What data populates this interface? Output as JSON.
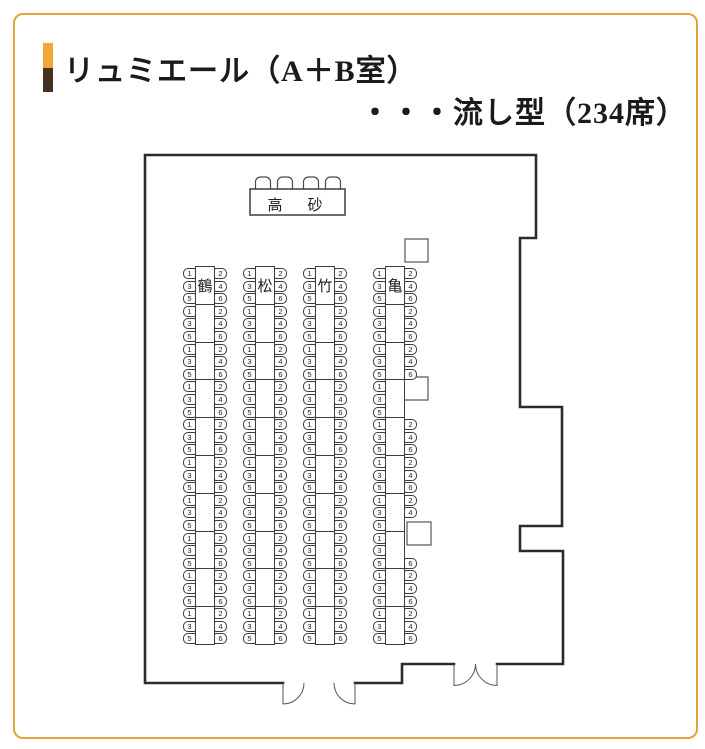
{
  "page": {
    "frame_color": "#E8A23B",
    "marker_top_color": "#F0A838",
    "marker_bottom_color": "#46311F",
    "wall_color": "#2b2b2b"
  },
  "title": {
    "line1": "リュミエール（A＋B室）",
    "line2": "・・・流し型（234席）",
    "total_seats": 234
  },
  "stage": {
    "label": "高　砂",
    "chair_count": 4
  },
  "floorplan": {
    "seat_rows_per_segment": 3,
    "tables": [
      {
        "label": "鶴",
        "x": 195,
        "segments": [
          [
            1,
            2,
            3,
            4,
            5,
            6
          ],
          [
            1,
            2,
            3,
            4,
            5,
            6
          ],
          [
            1,
            2,
            3,
            4,
            5,
            6
          ],
          [
            1,
            2,
            3,
            4,
            5,
            6
          ],
          [
            1,
            2,
            3,
            4,
            5,
            6
          ],
          [
            1,
            2,
            3,
            4,
            5,
            6
          ],
          [
            1,
            2,
            3,
            4,
            5,
            6
          ],
          [
            1,
            2,
            3,
            4,
            5,
            6
          ],
          [
            1,
            2,
            3,
            4,
            5,
            6
          ],
          [
            1,
            2,
            3,
            4,
            5,
            6
          ]
        ]
      },
      {
        "label": "松",
        "x": 255,
        "segments": [
          [
            1,
            2,
            3,
            4,
            5,
            6
          ],
          [
            1,
            2,
            3,
            4,
            5,
            6
          ],
          [
            1,
            2,
            3,
            4,
            5,
            6
          ],
          [
            1,
            2,
            3,
            4,
            5,
            6
          ],
          [
            1,
            2,
            3,
            4,
            5,
            6
          ],
          [
            1,
            2,
            3,
            4,
            5,
            6
          ],
          [
            1,
            2,
            3,
            4,
            5,
            6
          ],
          [
            1,
            2,
            3,
            4,
            5,
            6
          ],
          [
            1,
            2,
            3,
            4,
            5,
            6
          ],
          [
            1,
            2,
            3,
            4,
            5,
            6
          ]
        ]
      },
      {
        "label": "竹",
        "x": 315,
        "segments": [
          [
            1,
            2,
            3,
            4,
            5,
            6
          ],
          [
            1,
            2,
            3,
            4,
            5,
            6
          ],
          [
            1,
            2,
            3,
            4,
            5,
            6
          ],
          [
            1,
            2,
            3,
            4,
            5,
            6
          ],
          [
            1,
            2,
            3,
            4,
            5,
            6
          ],
          [
            1,
            2,
            3,
            4,
            5,
            6
          ],
          [
            1,
            2,
            3,
            4,
            5,
            6
          ],
          [
            1,
            2,
            3,
            4,
            5,
            6
          ],
          [
            1,
            2,
            3,
            4,
            5,
            6
          ],
          [
            1,
            2,
            3,
            4,
            5,
            6
          ]
        ]
      },
      {
        "label": "亀",
        "x": 385,
        "segments": [
          [
            1,
            2,
            3,
            4,
            5,
            6
          ],
          [
            1,
            2,
            3,
            4,
            5,
            6
          ],
          [
            1,
            2,
            3,
            4,
            5,
            6
          ],
          [
            1,
            3,
            5
          ],
          [
            1,
            2,
            3,
            4,
            5,
            6
          ],
          [
            1,
            2,
            3,
            4,
            5,
            6
          ],
          [
            1,
            2,
            3,
            4,
            5
          ],
          [
            1,
            3,
            5,
            6
          ],
          [
            1,
            2,
            3,
            4,
            5,
            6
          ],
          [
            1,
            2,
            3,
            4,
            5,
            6
          ]
        ]
      }
    ],
    "pillars": [
      {
        "x": 405,
        "y": 239,
        "w": 23,
        "h": 23
      },
      {
        "x": 404,
        "y": 377,
        "w": 24,
        "h": 23
      },
      {
        "x": 407,
        "y": 522,
        "w": 24,
        "h": 23
      }
    ]
  }
}
